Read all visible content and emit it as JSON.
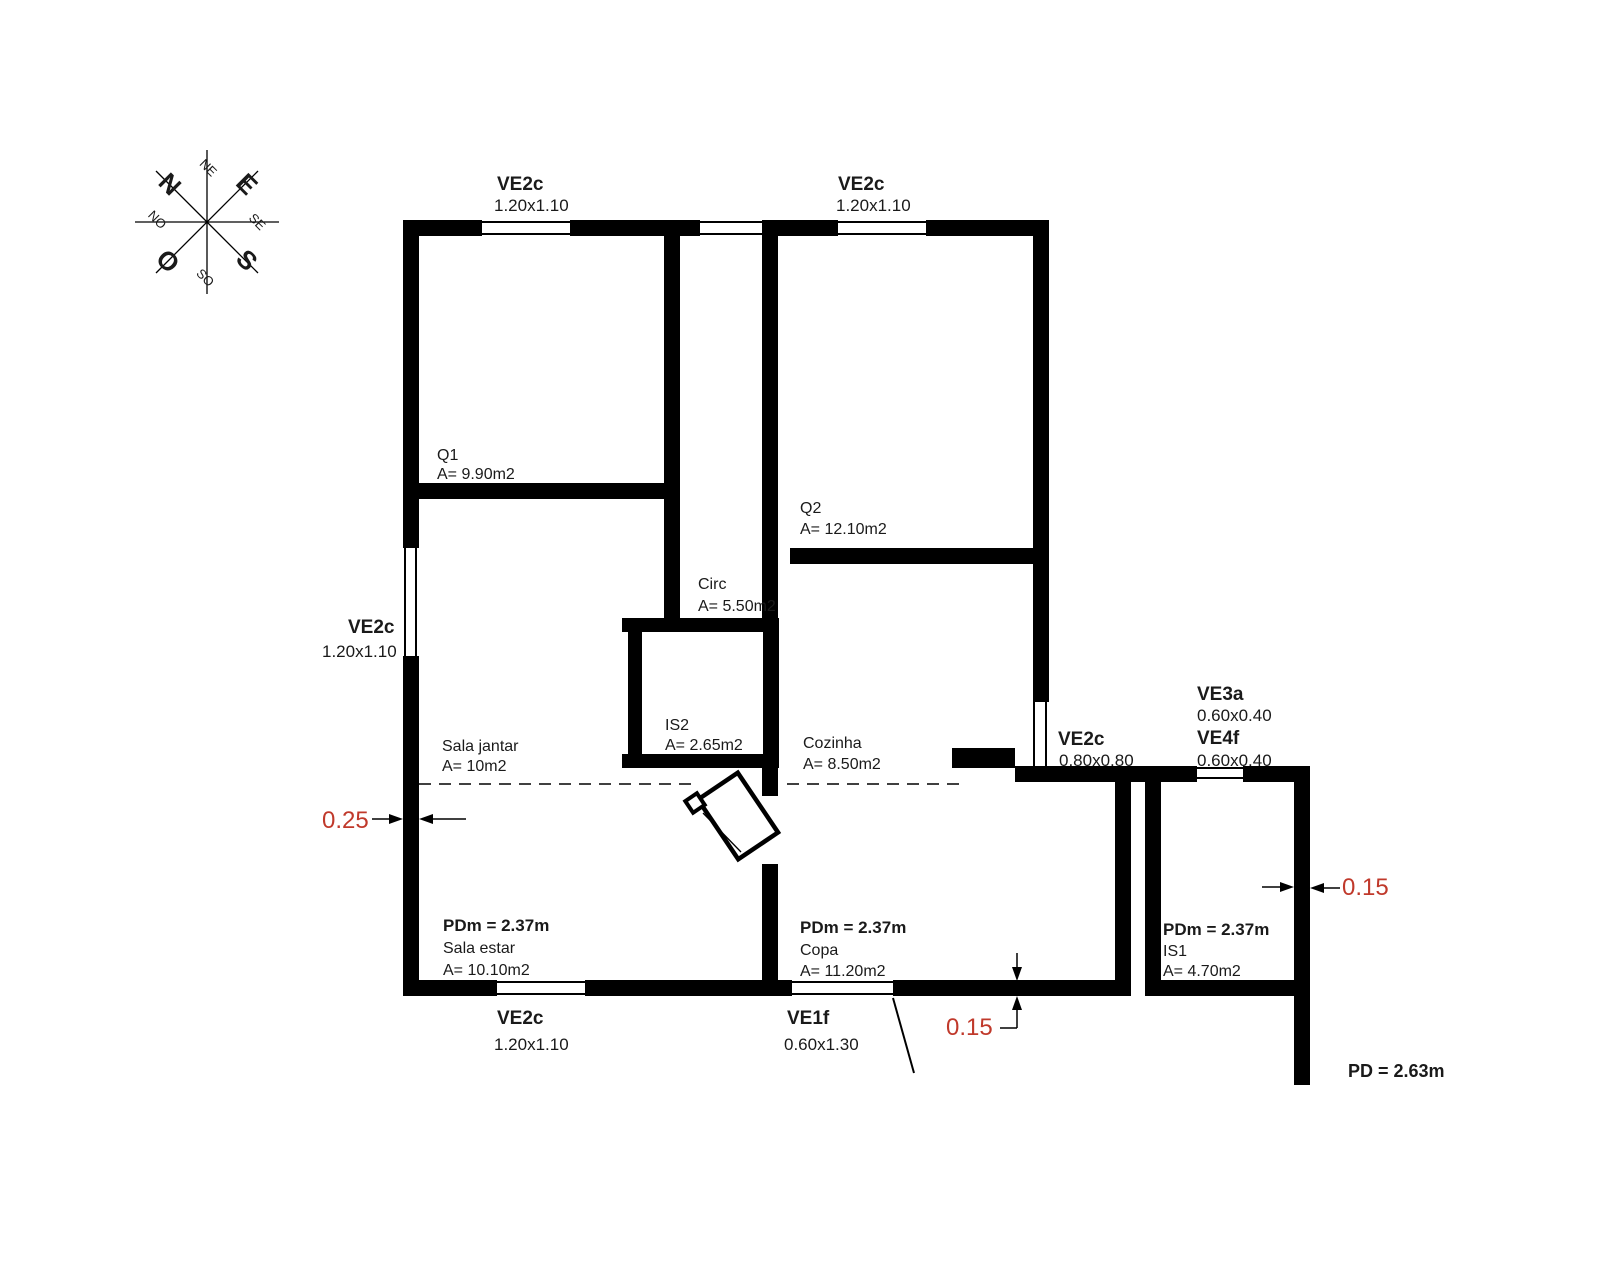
{
  "compass": {
    "n": "N",
    "e": "E",
    "s": "S",
    "o": "O",
    "ne": "NE",
    "se": "SE",
    "so": "SO",
    "no": "NO"
  },
  "windows": {
    "top1": {
      "code": "VE2c",
      "size": "1.20x1.10"
    },
    "top2": {
      "code": "VE2c",
      "size": "1.20x1.10"
    },
    "left": {
      "code": "VE2c",
      "size": "1.20x1.10"
    },
    "right": {
      "code": "VE2c",
      "size": "0.80x0.80"
    },
    "ve3a": {
      "code": "VE3a",
      "size": "0.60x0.40"
    },
    "ve4f": {
      "code": "VE4f",
      "size": "0.60x0.40"
    },
    "bottom": {
      "code": "VE2c",
      "size": "1.20x1.10"
    },
    "entry_door": {
      "code": "VE1f",
      "size": "0.60x1.30"
    }
  },
  "rooms": {
    "q1": {
      "name": "Q1",
      "area": "A= 9.90m2"
    },
    "q2": {
      "name": "Q2",
      "area": "A= 12.10m2"
    },
    "circ": {
      "name": "Circ",
      "area": "A= 5.50m2"
    },
    "is2": {
      "name": "IS2",
      "area": "A= 2.65m2"
    },
    "cozinha": {
      "name": "Cozinha",
      "area": "A= 8.50m2"
    },
    "sala_jantar": {
      "name": "Sala jantar",
      "area": "A= 10m2"
    },
    "sala_estar": {
      "ceiling": "PDm = 2.37m",
      "name": "Sala estar",
      "area": "A= 10.10m2"
    },
    "copa": {
      "ceiling": "PDm = 2.37m",
      "name": "Copa",
      "area": "A= 11.20m2"
    },
    "is1": {
      "ceiling": "PDm = 2.37m",
      "name": "IS1",
      "area": "A= 4.70m2"
    }
  },
  "dimensions": {
    "left_wall": "0.25",
    "bottom_wall": "0.15",
    "right_wall": "0.15",
    "exterior_ceiling": "PD = 2.63m"
  },
  "colors": {
    "dimension_red": "#c0392b",
    "line_black": "#000000",
    "background": "#ffffff"
  }
}
